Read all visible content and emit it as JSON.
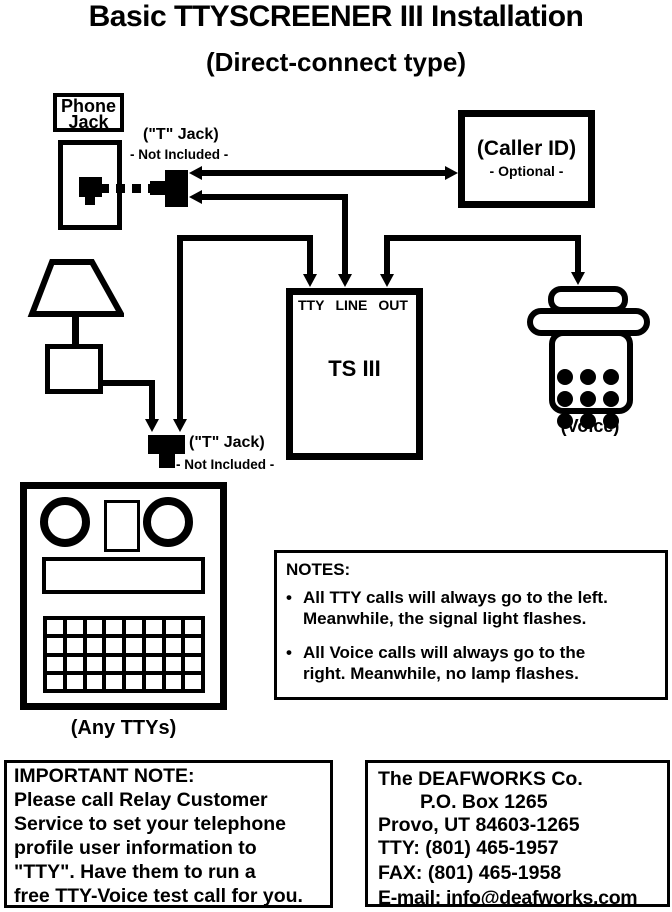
{
  "title": "Basic TTYSCREENER III Installation",
  "subtitle": "(Direct-connect type)",
  "colors": {
    "ink": "#000000",
    "paper": "#ffffff"
  },
  "phone_jack": {
    "label": "Phone\nJack"
  },
  "t_jack_top": {
    "label": "(\"T\" Jack)",
    "sublabel": "- Not Included -"
  },
  "t_jack_bottom": {
    "label": "(\"T\" Jack)",
    "sublabel": "- Not Included -"
  },
  "caller_id": {
    "title": "(Caller ID)",
    "subtitle": "- Optional -"
  },
  "ts3": {
    "ports": {
      "tty": "TTY",
      "line": "LINE",
      "out": "OUT"
    },
    "name": "TS III"
  },
  "voice": {
    "label": "(Voice)"
  },
  "tty_device": {
    "label": "(Any TTYs)"
  },
  "notes": {
    "heading": "NOTES:",
    "bullet": "•",
    "items": [
      {
        "text": "All TTY calls will always go to the left.\nMeanwhile, the signal light flashes."
      },
      {
        "text": "All Voice calls will always go to the\nright.  Meanwhile, no lamp flashes."
      }
    ]
  },
  "important_note": {
    "text": "IMPORTANT NOTE:\nPlease call Relay Customer\nService to set your telephone\nprofile user information to\n\"TTY\".    Have them to run a\nfree TTY-Voice test call for you."
  },
  "company": {
    "lines": [
      "The DEAFWORKS Co.",
      "P.O. Box 1265",
      "Provo, UT  84603-1265",
      "TTY: (801) 465-1957",
      "FAX: (801) 465-1958",
      "E-mail: info@deafworks.com"
    ]
  }
}
